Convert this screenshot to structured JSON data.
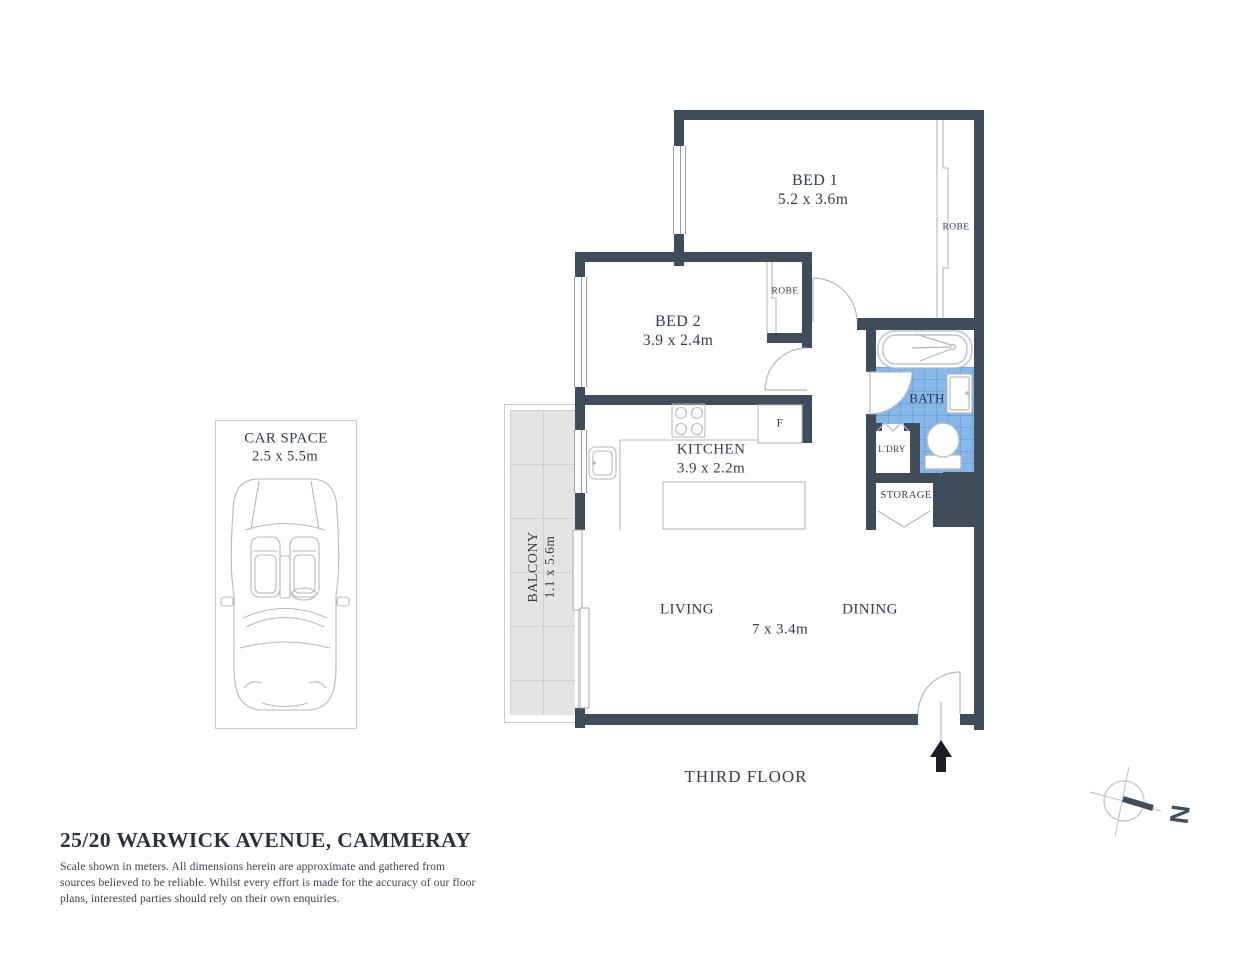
{
  "colors": {
    "wall": "#3F4C59",
    "line": "#B3B9BE",
    "text": "#333E4A",
    "bath_floor": "#87B6EA",
    "balcony_floor": "#E4E4E2",
    "arrow": "#1A1F26"
  },
  "rooms": {
    "bed1": {
      "name": "BED 1",
      "dims": "5.2 x 3.6m"
    },
    "bed2": {
      "name": "BED 2",
      "dims": "3.9 x 2.4m"
    },
    "kitchen": {
      "name": "KITCHEN",
      "dims": "3.9 x 2.2m"
    },
    "living": {
      "name": "LIVING"
    },
    "dining": {
      "name": "DINING"
    },
    "living_dining": {
      "dims": "7 x 3.4m"
    },
    "bath": {
      "name": "BATH"
    },
    "laundry": {
      "name": "L'DRY"
    },
    "storage": {
      "name": "STORAGE"
    },
    "balcony": {
      "name": "BALCONY",
      "dims": "1.1 x 5.6m"
    }
  },
  "labels": {
    "robe": "ROBE",
    "fridge": "F"
  },
  "floor": {
    "label": "THIRD FLOOR"
  },
  "car_space": {
    "name": "CAR SPACE",
    "dims": "2.5 x 5.5m"
  },
  "compass": {
    "north_label": "N"
  },
  "footer": {
    "title": "25/20 WARWICK AVENUE, CAMMERAY",
    "disclaimer_lines": [
      "Scale shown in meters. All dimensions herein are approximate and gathered from",
      "sources believed to be  reliable. Whilst every effort is made for the accuracy of our floor",
      "plans, interested parties should rely on their own enquiries."
    ]
  }
}
